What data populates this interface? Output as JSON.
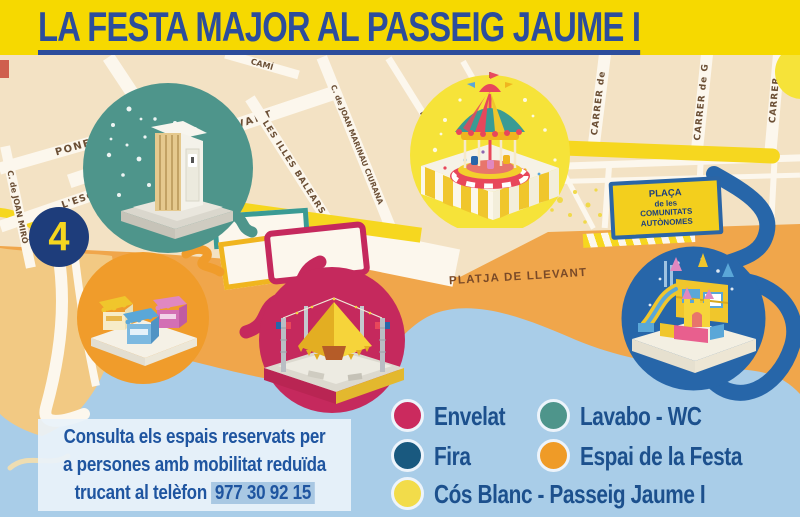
{
  "header": {
    "title": "LA FESTA MAJOR AL PASSEIG JAUME I"
  },
  "colors": {
    "header_bg": "#f6d900",
    "title_blue": "#2c4d9c",
    "map_tan": "#f3e2c4",
    "street_white": "#fcf7ed",
    "beach_orange": "#f0a64b",
    "sand_light": "#f2c983",
    "water_blue": "#a9cde8",
    "route_yellow": "#f6d71f",
    "navy_badge": "#1e3d7b",
    "text_blue": "#1c508d",
    "street_text": "#6b4f35",
    "beach_text": "#7a4a28"
  },
  "map": {
    "streets": [
      {
        "label": "BARCELONA"
      },
      {
        "label": "CARRER  de  LLEVANT"
      },
      {
        "label": "LES ILLES BALEARS"
      },
      {
        "label": "PONENT"
      },
      {
        "label": "L'ESGLÉSIA"
      },
      {
        "label": "C. de JOAN MIRÓ"
      },
      {
        "label": "CAMÍ"
      },
      {
        "label": "C. de JOAN MARINAU CIURANA"
      },
      {
        "label": "PARIS"
      },
      {
        "label": "CARRER  de"
      },
      {
        "label": "CARRER  de  G"
      },
      {
        "label": "CARRER"
      }
    ],
    "beach_label": "PLATJA DE LLEVANT",
    "area_number": "4",
    "plaza_sign": {
      "line1": "PLAÇA",
      "line2": "de les",
      "line3": "COMUNITATS AUTÒNOMES"
    },
    "markers": [
      {
        "name": "lavabo-wc",
        "color": "#4e958b"
      },
      {
        "name": "cos-blanc-carousel",
        "color": "#f6e339"
      },
      {
        "name": "espai-festa-stalls",
        "color": "#f09c2b"
      },
      {
        "name": "envelat-tent",
        "color": "#c5295d"
      },
      {
        "name": "fira-castle",
        "color": "#2766a9"
      }
    ]
  },
  "legend": {
    "items": [
      {
        "label": "Envelat",
        "color": "#cb2a5e"
      },
      {
        "label": "Lavabo - WC",
        "color": "#4e958b"
      },
      {
        "label": "Fira",
        "color": "#19597f"
      },
      {
        "label": "Espai de la Festa",
        "color": "#ef9b27"
      },
      {
        "label": "Cós Blanc - Passeig Jaume I",
        "color": "#f2dc4a"
      }
    ]
  },
  "info_box": {
    "line1": "Consulta els espais reservats per",
    "line2": "a persones amb mobilitat reduïda",
    "line3_prefix": "trucant al telèfon",
    "phone": "977 30 92 15"
  }
}
